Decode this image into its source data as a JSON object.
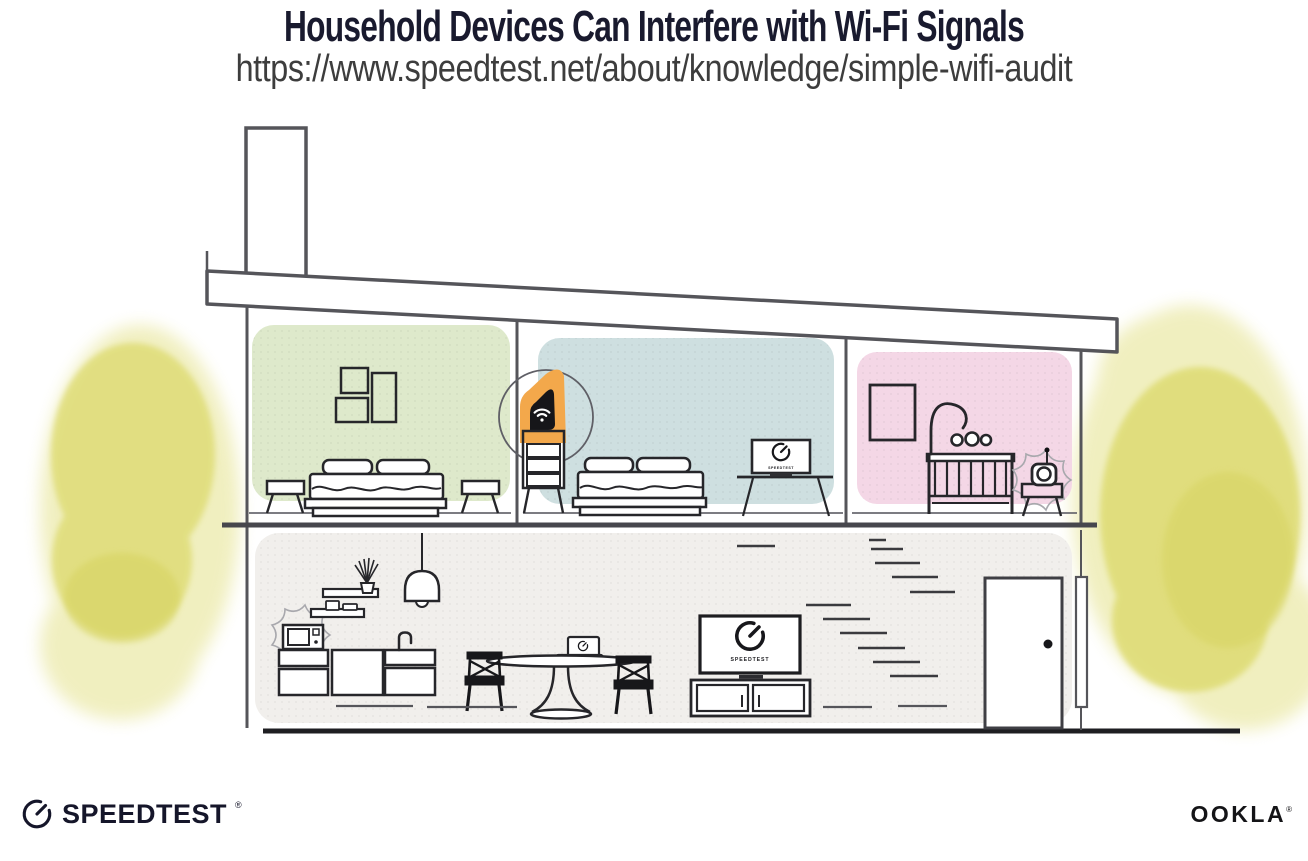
{
  "header": {
    "title": "Household Devices Can Interfere with Wi-Fi Signals",
    "url": "https://www.speedtest.net/about/knowledge/simple-wifi-audit"
  },
  "illustration": {
    "monitor_screen_label": "SPEEDTEST",
    "tv_screen_label": "SPEEDTEST",
    "devices": {
      "router": "wifi-router",
      "interfering_devices": [
        "microwave",
        "baby-monitor"
      ],
      "speedtest_screens": [
        "desktop-monitor",
        "tv",
        "laptop"
      ]
    },
    "colors": {
      "bedroom_left_wall": "#dee9cb",
      "bedroom_middle_wall": "#cedfe0",
      "nursery_wall": "#f4d7e6",
      "ground_floor_wall": "#f1efec",
      "router_highlight": "#f3a84b",
      "foliage": "#dedb72",
      "line_art": "#55555a",
      "furniture_ink": "#26262a",
      "title_ink": "#191a2e"
    }
  },
  "footer": {
    "speedtest_wordmark": "SPEEDTEST",
    "speedtest_trademark": "®",
    "ookla_wordmark": "OOKLA",
    "ookla_trademark": "®"
  }
}
